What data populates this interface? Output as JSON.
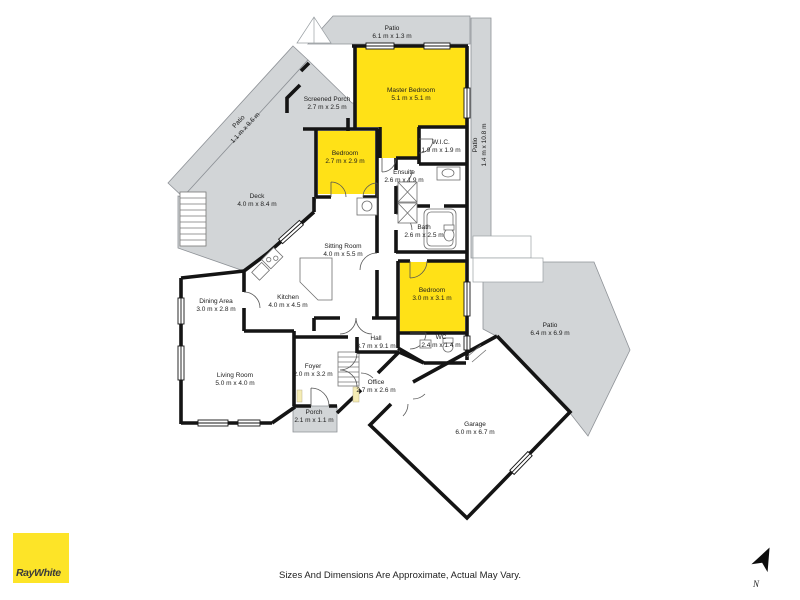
{
  "branding": {
    "agency": "RayWhite"
  },
  "footer": {
    "disclaimer": "Sizes And Dimensions Are Approximate, Actual May Vary."
  },
  "compass": {
    "label": "N"
  },
  "colors": {
    "highlight_yellow": "#ffe117",
    "area_gray": "#d2d5d7",
    "area_gray_stroke": "#8e9297",
    "wall_black": "#141414",
    "logo_yellow": "#fde428"
  },
  "rooms": [
    {
      "name": "Patio",
      "dims": "6.1 m x 1.3 m"
    },
    {
      "name": "Master Bedroom",
      "dims": "5.1 m x 5.1 m"
    },
    {
      "name": "Screened Porch",
      "dims": "2.7 m x 2.5 m"
    },
    {
      "name": "Patio",
      "dims": "1.1 m x 9.6 m"
    },
    {
      "name": "Deck",
      "dims": "4.0 m x 8.4 m"
    },
    {
      "name": "Bedroom",
      "dims": "2.7 m x 2.9 m"
    },
    {
      "name": "W.I.C.",
      "dims": "1.9 m x 1.9 m"
    },
    {
      "name": "Ensuite",
      "dims": "2.6 m x 1.9 m"
    },
    {
      "name": "Patio",
      "dims": "1.4 m x 10.8 m"
    },
    {
      "name": "Bath",
      "dims": "2.6 m x 2.5 m"
    },
    {
      "name": "Sitting Room",
      "dims": "4.0 m x 5.5 m"
    },
    {
      "name": "Kitchen",
      "dims": "4.0 m x 4.5 m"
    },
    {
      "name": "Dining Area",
      "dims": "3.0 m x 2.8 m"
    },
    {
      "name": "Living Room",
      "dims": "5.0 m x 4.0 m"
    },
    {
      "name": "Bedroom",
      "dims": "3.0 m x 3.1 m"
    },
    {
      "name": "WC",
      "dims": "2.4 m x 1.4 m"
    },
    {
      "name": "Patio",
      "dims": "6.4 m x 6.9 m"
    },
    {
      "name": "Hall",
      "dims": "3.7 m x 9.1 m"
    },
    {
      "name": "Foyer",
      "dims": "2.0 m x 3.2 m"
    },
    {
      "name": "Office",
      "dims": "2.7 m x 2.6 m"
    },
    {
      "name": "Porch",
      "dims": "2.1 m x 1.1 m"
    },
    {
      "name": "Garage",
      "dims": "6.0 m x 6.7 m"
    }
  ]
}
